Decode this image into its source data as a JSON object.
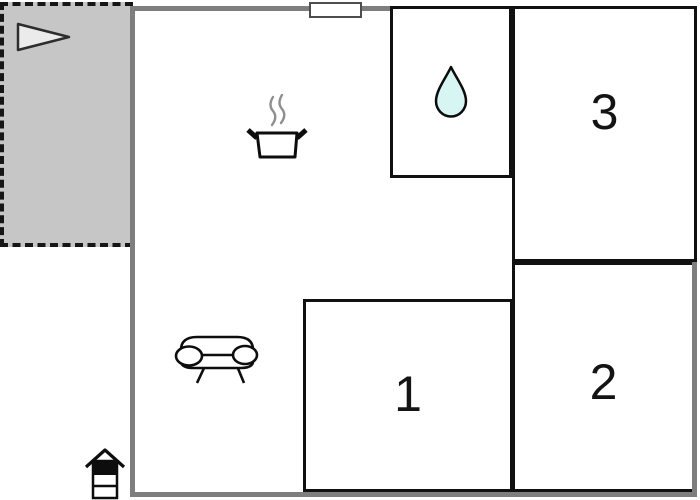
{
  "plan": {
    "rooms": [
      {
        "name": "room-1",
        "label": "1"
      },
      {
        "name": "room-2",
        "label": "2"
      },
      {
        "name": "room-3",
        "label": "3"
      },
      {
        "name": "bathroom",
        "label": ""
      },
      {
        "name": "main-room-kitchen-living",
        "label": ""
      },
      {
        "name": "terrace",
        "label": ""
      }
    ],
    "icons": [
      "flag-icon",
      "cooking-pot-icon",
      "steam-icon",
      "water-drop-icon",
      "sofa-icon",
      "grill-icon",
      "door-marker"
    ],
    "colors": {
      "terrace_fill": "#c6c6c6",
      "wall_gray": "#7e7e7e",
      "room_outline": "#111111",
      "water_drop_fill": "#d6f5f3",
      "flag_fill": "#ebebeb",
      "steam_gray": "#8f8f8f"
    }
  }
}
